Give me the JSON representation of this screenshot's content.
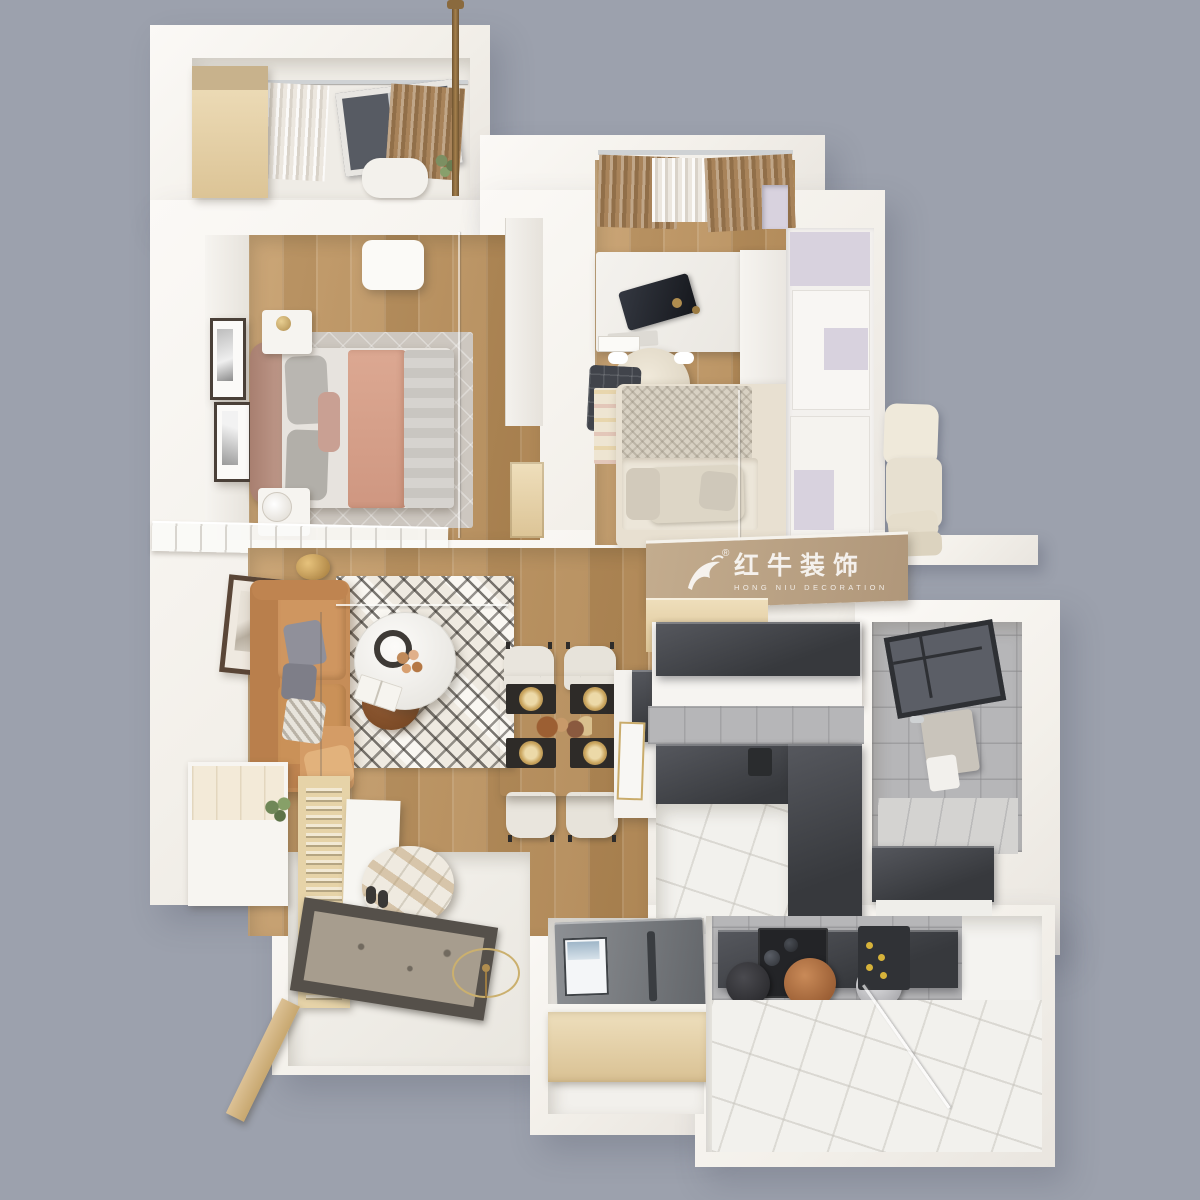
{
  "watermark": {
    "logo": "bull-logo",
    "registered_mark": "®",
    "brand_cn": "红牛装饰",
    "brand_en": "HONG NIU DECORATION"
  },
  "palette": {
    "background": "#9ca1ad",
    "wall_white": "#f6f4f0",
    "wood_floor": "#bd9260",
    "wood_cabinet": "#ead9b5",
    "sofa_leather": "#c68d58",
    "curtain_brown": "#a8835a",
    "counter_dark": "#44464b",
    "tile_wall_gray": "#b6b6b8",
    "tile_floor": "#f2f1ed",
    "wardrobe_lavender": "#d8d2de",
    "bed_duvet_pink": "#d7a18e",
    "copper_pot": "#b97748",
    "watermark_text": "rgba(255,255,255,0.85)"
  },
  "scene": {
    "type": "3d-floor-plan-render",
    "view": "top-down",
    "rooms": [
      "balcony-lounge",
      "master-bedroom",
      "study-bedroom",
      "side-balcony",
      "living-room",
      "dining-area",
      "kitchen",
      "bathroom",
      "entry-hall",
      "utility-kitchen"
    ]
  }
}
